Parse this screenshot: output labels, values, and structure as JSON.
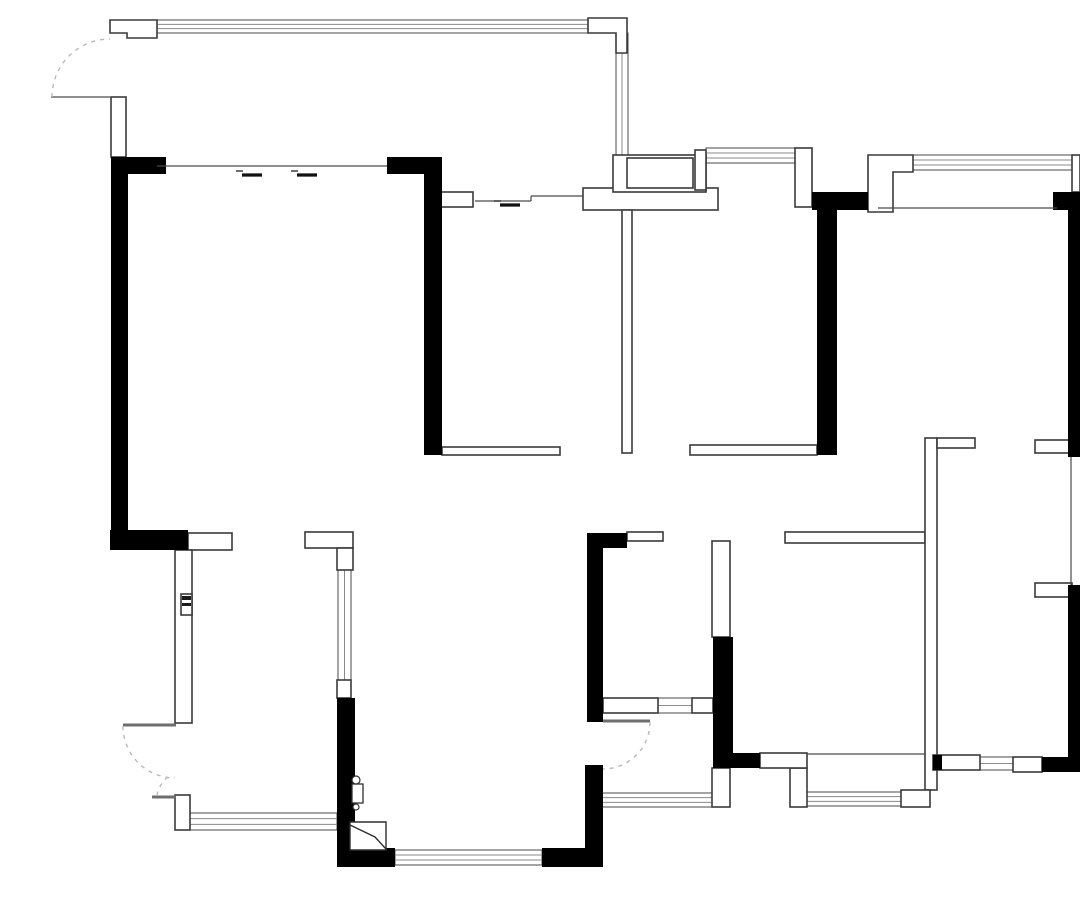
{
  "canvas": {
    "width": 1080,
    "height": 898,
    "background": "#ffffff"
  },
  "style": {
    "wall_fill": "#000000",
    "hollow_fill": "#ffffff",
    "hollow_stroke": "#3a3a3a",
    "hollow_stroke_width": 1.6,
    "window_stroke": "#8a8a8a",
    "window_frame_stroke": "#4a4a4a",
    "thin_line_stroke": "#4a4a4a",
    "leaf_stroke": "#6e6e6e",
    "arc_stroke": "#b9b9b9",
    "symbol_stroke": "#2f2f2f"
  },
  "black_walls": [
    {
      "id": "w-topleft-h",
      "x": 111,
      "y": 157,
      "w": 55,
      "h": 17
    },
    {
      "id": "w-left-v",
      "x": 111,
      "y": 157,
      "w": 17,
      "h": 373
    },
    {
      "id": "w-left-bottom-h",
      "x": 110,
      "y": 530,
      "w": 78,
      "h": 20
    },
    {
      "id": "w-kitchen-left-h",
      "x": 387,
      "y": 157,
      "w": 55,
      "h": 17
    },
    {
      "id": "w-kitchen-left-v",
      "x": 424,
      "y": 157,
      "w": 18,
      "h": 298
    },
    {
      "id": "w-midright-top-h",
      "x": 812,
      "y": 192,
      "w": 56,
      "h": 18
    },
    {
      "id": "w-midright-v",
      "x": 817,
      "y": 192,
      "w": 20,
      "h": 263
    },
    {
      "id": "w-topright-corner",
      "x": 1053,
      "y": 192,
      "w": 27,
      "h": 18
    },
    {
      "id": "w-right-upper-v",
      "x": 1068,
      "y": 210,
      "w": 12,
      "h": 247
    },
    {
      "id": "w-right-lower-v",
      "x": 1068,
      "y": 585,
      "w": 12,
      "h": 187
    },
    {
      "id": "w-br-bottom-corner",
      "x": 1042,
      "y": 757,
      "w": 38,
      "h": 15
    },
    {
      "id": "w-center-right-v",
      "x": 713,
      "y": 637,
      "w": 20,
      "h": 116
    },
    {
      "id": "w-center-right-h",
      "x": 713,
      "y": 753,
      "w": 47,
      "h": 15
    },
    {
      "id": "w-hall-corner",
      "x": 587,
      "y": 533,
      "w": 40,
      "h": 15
    },
    {
      "id": "w-hall-v",
      "x": 587,
      "y": 548,
      "w": 16,
      "h": 174
    },
    {
      "id": "w-bath-door-v",
      "x": 585,
      "y": 765,
      "w": 18,
      "h": 83
    },
    {
      "id": "w-bottom-center-h",
      "x": 542,
      "y": 848,
      "w": 61,
      "h": 19
    },
    {
      "id": "w-bottom-left-h",
      "x": 337,
      "y": 848,
      "w": 58,
      "h": 19
    },
    {
      "id": "w-leftcenter-v",
      "x": 337,
      "y": 698,
      "w": 18,
      "h": 150
    },
    {
      "id": "w-br-bottom-left-bit",
      "x": 933,
      "y": 755,
      "w": 9,
      "h": 15
    }
  ],
  "hollow_walls": [
    {
      "id": "p-entry-post",
      "x": 111,
      "y": 97,
      "w": 15,
      "h": 60
    },
    {
      "id": "p-junction-bar",
      "x": 583,
      "y": 188,
      "w": 135,
      "h": 22
    },
    {
      "id": "p-junction-upper",
      "x": 613,
      "y": 155,
      "w": 93,
      "h": 37
    },
    {
      "id": "p-junction-niche",
      "x": 627,
      "y": 158,
      "w": 66,
      "h": 30
    },
    {
      "id": "p-post-695",
      "x": 695,
      "y": 150,
      "w": 11,
      "h": 40
    },
    {
      "id": "p-post-795",
      "x": 795,
      "y": 148,
      "w": 17,
      "h": 59
    },
    {
      "id": "p-right-cap",
      "x": 1072,
      "y": 155,
      "w": 8,
      "h": 37
    },
    {
      "id": "p-slider-block",
      "x": 441,
      "y": 192,
      "w": 32,
      "h": 15
    },
    {
      "id": "p-stub-188",
      "x": 188,
      "y": 533,
      "w": 44,
      "h": 17
    },
    {
      "id": "p-lpost-h",
      "x": 305,
      "y": 532,
      "w": 48,
      "h": 16
    },
    {
      "id": "p-lpost-leg",
      "x": 337,
      "y": 548,
      "w": 16,
      "h": 22
    },
    {
      "id": "p-post-337",
      "x": 337,
      "y": 680,
      "w": 14,
      "h": 18
    },
    {
      "id": "p-door-post-bl",
      "x": 175,
      "y": 795,
      "w": 15,
      "h": 35
    },
    {
      "id": "p-stub-627",
      "x": 627,
      "y": 532,
      "w": 36,
      "h": 9
    },
    {
      "id": "p-bed1-bar-left",
      "x": 442,
      "y": 447,
      "w": 118,
      "h": 8
    },
    {
      "id": "p-thin-622",
      "x": 622,
      "y": 210,
      "w": 10,
      "h": 243
    },
    {
      "id": "p-bed1-bar-right",
      "x": 690,
      "y": 445,
      "w": 127,
      "h": 10
    },
    {
      "id": "p-hall-south-bar",
      "x": 785,
      "y": 532,
      "w": 140,
      "h": 11
    },
    {
      "id": "p-thin-925",
      "x": 925,
      "y": 438,
      "w": 12,
      "h": 352
    },
    {
      "id": "p-stub-937",
      "x": 937,
      "y": 438,
      "w": 38,
      "h": 10
    },
    {
      "id": "p-stub-1035-top",
      "x": 1035,
      "y": 440,
      "w": 37,
      "h": 13
    },
    {
      "id": "p-stub-1035-bot",
      "x": 1035,
      "y": 583,
      "w": 37,
      "h": 14
    },
    {
      "id": "p-br-bottom-hollow-l",
      "x": 933,
      "y": 755,
      "w": 47,
      "h": 15
    },
    {
      "id": "p-br-bottom-hollow-r",
      "x": 1013,
      "y": 757,
      "w": 29,
      "h": 15
    },
    {
      "id": "p-box-901",
      "x": 901,
      "y": 790,
      "w": 29,
      "h": 17
    },
    {
      "id": "p-post-790",
      "x": 790,
      "y": 768,
      "w": 17,
      "h": 39
    },
    {
      "id": "p-post-712",
      "x": 712,
      "y": 768,
      "w": 18,
      "h": 39
    },
    {
      "id": "p-bar-760",
      "x": 760,
      "y": 753,
      "w": 47,
      "h": 15
    },
    {
      "id": "p-post-712-upper",
      "x": 712,
      "y": 541,
      "w": 18,
      "h": 96
    },
    {
      "id": "p-band-left",
      "x": 603,
      "y": 698,
      "w": 55,
      "h": 15
    },
    {
      "id": "p-band-right",
      "x": 692,
      "y": 698,
      "w": 21,
      "h": 15
    },
    {
      "id": "p-entry-thin-wall",
      "x": 175,
      "y": 550,
      "w": 17,
      "h": 173
    },
    {
      "id": "p-lock-box",
      "x": 181,
      "y": 594,
      "w": 11,
      "h": 21
    }
  ],
  "hollow_polys": [
    {
      "id": "p-topleft-window-post",
      "points": "110,20 157,20 157,38 127,38 127,33 110,33"
    },
    {
      "id": "p-topcenter-window-post",
      "points": "588,18 627,18 627,53 616,53 616,33 588,33"
    },
    {
      "id": "p-topright-window-post",
      "points": "868,155 913,155 913,172 893,172 893,212 868,212"
    }
  ],
  "windows": [
    {
      "id": "win-top-left",
      "x": 157,
      "y": 20,
      "w": 431,
      "h": 13,
      "orient": "h",
      "lines": 2
    },
    {
      "id": "win-kitchen-col",
      "x": 616,
      "y": 33,
      "w": 12,
      "h": 122,
      "orient": "v",
      "lines": 1
    },
    {
      "id": "win-top-706",
      "x": 706,
      "y": 148,
      "w": 89,
      "h": 15,
      "orient": "h",
      "lines": 2
    },
    {
      "id": "win-top-right",
      "x": 913,
      "y": 155,
      "w": 162,
      "h": 15,
      "orient": "h",
      "lines": 2
    },
    {
      "id": "win-left-center-v",
      "x": 338,
      "y": 570,
      "w": 13,
      "h": 110,
      "orient": "v",
      "lines": 1
    },
    {
      "id": "win-bottom-entry",
      "x": 190,
      "y": 813,
      "w": 147,
      "h": 17,
      "orient": "h",
      "lines": 2
    },
    {
      "id": "win-bottom-living",
      "x": 395,
      "y": 850,
      "w": 147,
      "h": 15,
      "orient": "h",
      "lines": 2
    },
    {
      "id": "win-bath-bottom-l",
      "x": 600,
      "y": 793,
      "w": 112,
      "h": 14,
      "orient": "h",
      "lines": 2
    },
    {
      "id": "win-bath-bottom-r",
      "x": 807,
      "y": 792,
      "w": 94,
      "h": 14,
      "orient": "h",
      "lines": 2
    },
    {
      "id": "win-br-bottom",
      "x": 980,
      "y": 757,
      "w": 33,
      "h": 13,
      "orient": "h",
      "lines": 1
    },
    {
      "id": "win-band-small",
      "x": 658,
      "y": 698,
      "w": 34,
      "h": 15,
      "orient": "h",
      "lines": 1
    }
  ],
  "thin_lines": [
    {
      "id": "ln-balcony-slider",
      "x1": 157,
      "y1": 166,
      "x2": 387,
      "y2": 166
    },
    {
      "id": "ln-inner-top-1",
      "x1": 583,
      "y1": 210,
      "x2": 718,
      "y2": 210
    },
    {
      "id": "ln-inner-top-2",
      "x1": 878,
      "y1": 208,
      "x2": 1057,
      "y2": 208
    },
    {
      "id": "ln-right-thin-edge",
      "x1": 1071,
      "y1": 457,
      "x2": 1071,
      "y2": 585
    },
    {
      "id": "ln-bath2-top",
      "x1": 807,
      "y1": 754,
      "x2": 925,
      "y2": 754
    },
    {
      "id": "ln-entry-leaf-top",
      "x1": 51,
      "y1": 97,
      "x2": 110,
      "y2": 97
    },
    {
      "id": "ln-slider-track-a",
      "x1": 475,
      "y1": 201,
      "x2": 531,
      "y2": 201
    },
    {
      "id": "ln-slider-track-jog",
      "x1": 531,
      "y1": 196,
      "x2": 531,
      "y2": 201
    },
    {
      "id": "ln-slider-track-b",
      "x1": 531,
      "y1": 196,
      "x2": 583,
      "y2": 196
    }
  ],
  "door_leaves": [
    {
      "id": "leaf-entry-lower-top",
      "x1": 123,
      "y1": 725,
      "x2": 176,
      "y2": 725
    },
    {
      "id": "leaf-entry-lower-bot",
      "x1": 152,
      "y1": 797,
      "x2": 176,
      "y2": 797
    },
    {
      "id": "leaf-bath-door",
      "x1": 603,
      "y1": 721,
      "x2": 650,
      "y2": 721
    }
  ],
  "slider_marks": [
    {
      "id": "slider-living-1",
      "x": 242,
      "y": 175
    },
    {
      "id": "slider-living-2",
      "x": 297,
      "y": 175
    },
    {
      "id": "slider-kitchen",
      "x": 500,
      "y": 205
    }
  ],
  "door_arcs": [
    {
      "id": "arc-entry-top",
      "d": "M52,97 A58,58 0 0 1 110,39"
    },
    {
      "id": "arc-entry-lower",
      "d": "M123,726 A52,52 0 0 0 175,778"
    },
    {
      "id": "arc-entry-lower-ext",
      "d": "M168,777 A30,30 0 0 0 157,795"
    },
    {
      "id": "arc-bath-door",
      "d": "M650,722 A47,47 0 0 1 603,769"
    }
  ],
  "symbols": {
    "lock_bands": [
      {
        "id": "sym-lock-band-1",
        "x": 182,
        "y": 596,
        "w": 9,
        "h": 4
      },
      {
        "id": "sym-lock-band-2",
        "x": 182,
        "y": 603,
        "w": 9,
        "h": 3
      }
    ],
    "hinge_circles": [
      {
        "id": "sym-hinge-circle-top",
        "cx": 356,
        "cy": 780,
        "r": 4
      },
      {
        "id": "sym-hinge-circle-bot",
        "cx": 356,
        "cy": 807,
        "r": 3
      }
    ],
    "hinge_rect": {
      "id": "sym-hinge-plate",
      "x": 352,
      "y": 784,
      "w": 11,
      "h": 19
    },
    "fold_door_rect": {
      "id": "sym-folddoor-frame",
      "d": "M350,822 L386,822 L386,850 L350,850 Z"
    },
    "fold_door_diag": {
      "id": "sym-folddoor-leaf",
      "d": "M350,825 L375,837 L386,849"
    }
  }
}
